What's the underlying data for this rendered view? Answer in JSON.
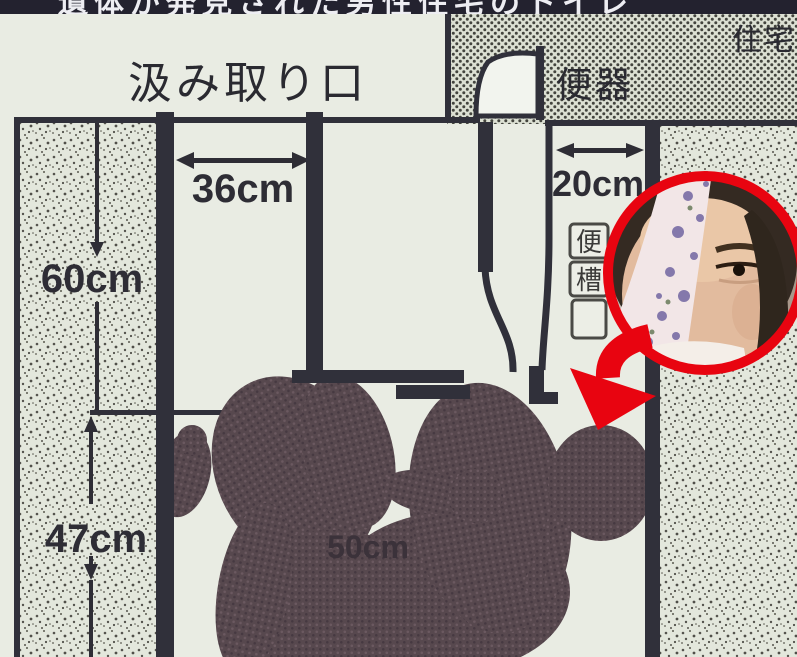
{
  "banner": {
    "headline": "遺体が発見された男性住宅のトイレ"
  },
  "labels": {
    "pump_out_opening": "汲み取り口",
    "toilet_bowl": "便器",
    "residence": "住宅",
    "tank_char_top": "便",
    "tank_char_bottom": "槽"
  },
  "dimensions": {
    "opening_width": "36cm",
    "rear_gap": "20cm",
    "upper_depth": "60cm",
    "lower_depth": "47cm",
    "body_span": "50cm"
  },
  "colors": {
    "accent_red": "#e80410",
    "ink": "#30303a",
    "paper": "#e9ece3",
    "silhouette_dark": "#57484e",
    "banner_bg": "#23222f"
  }
}
